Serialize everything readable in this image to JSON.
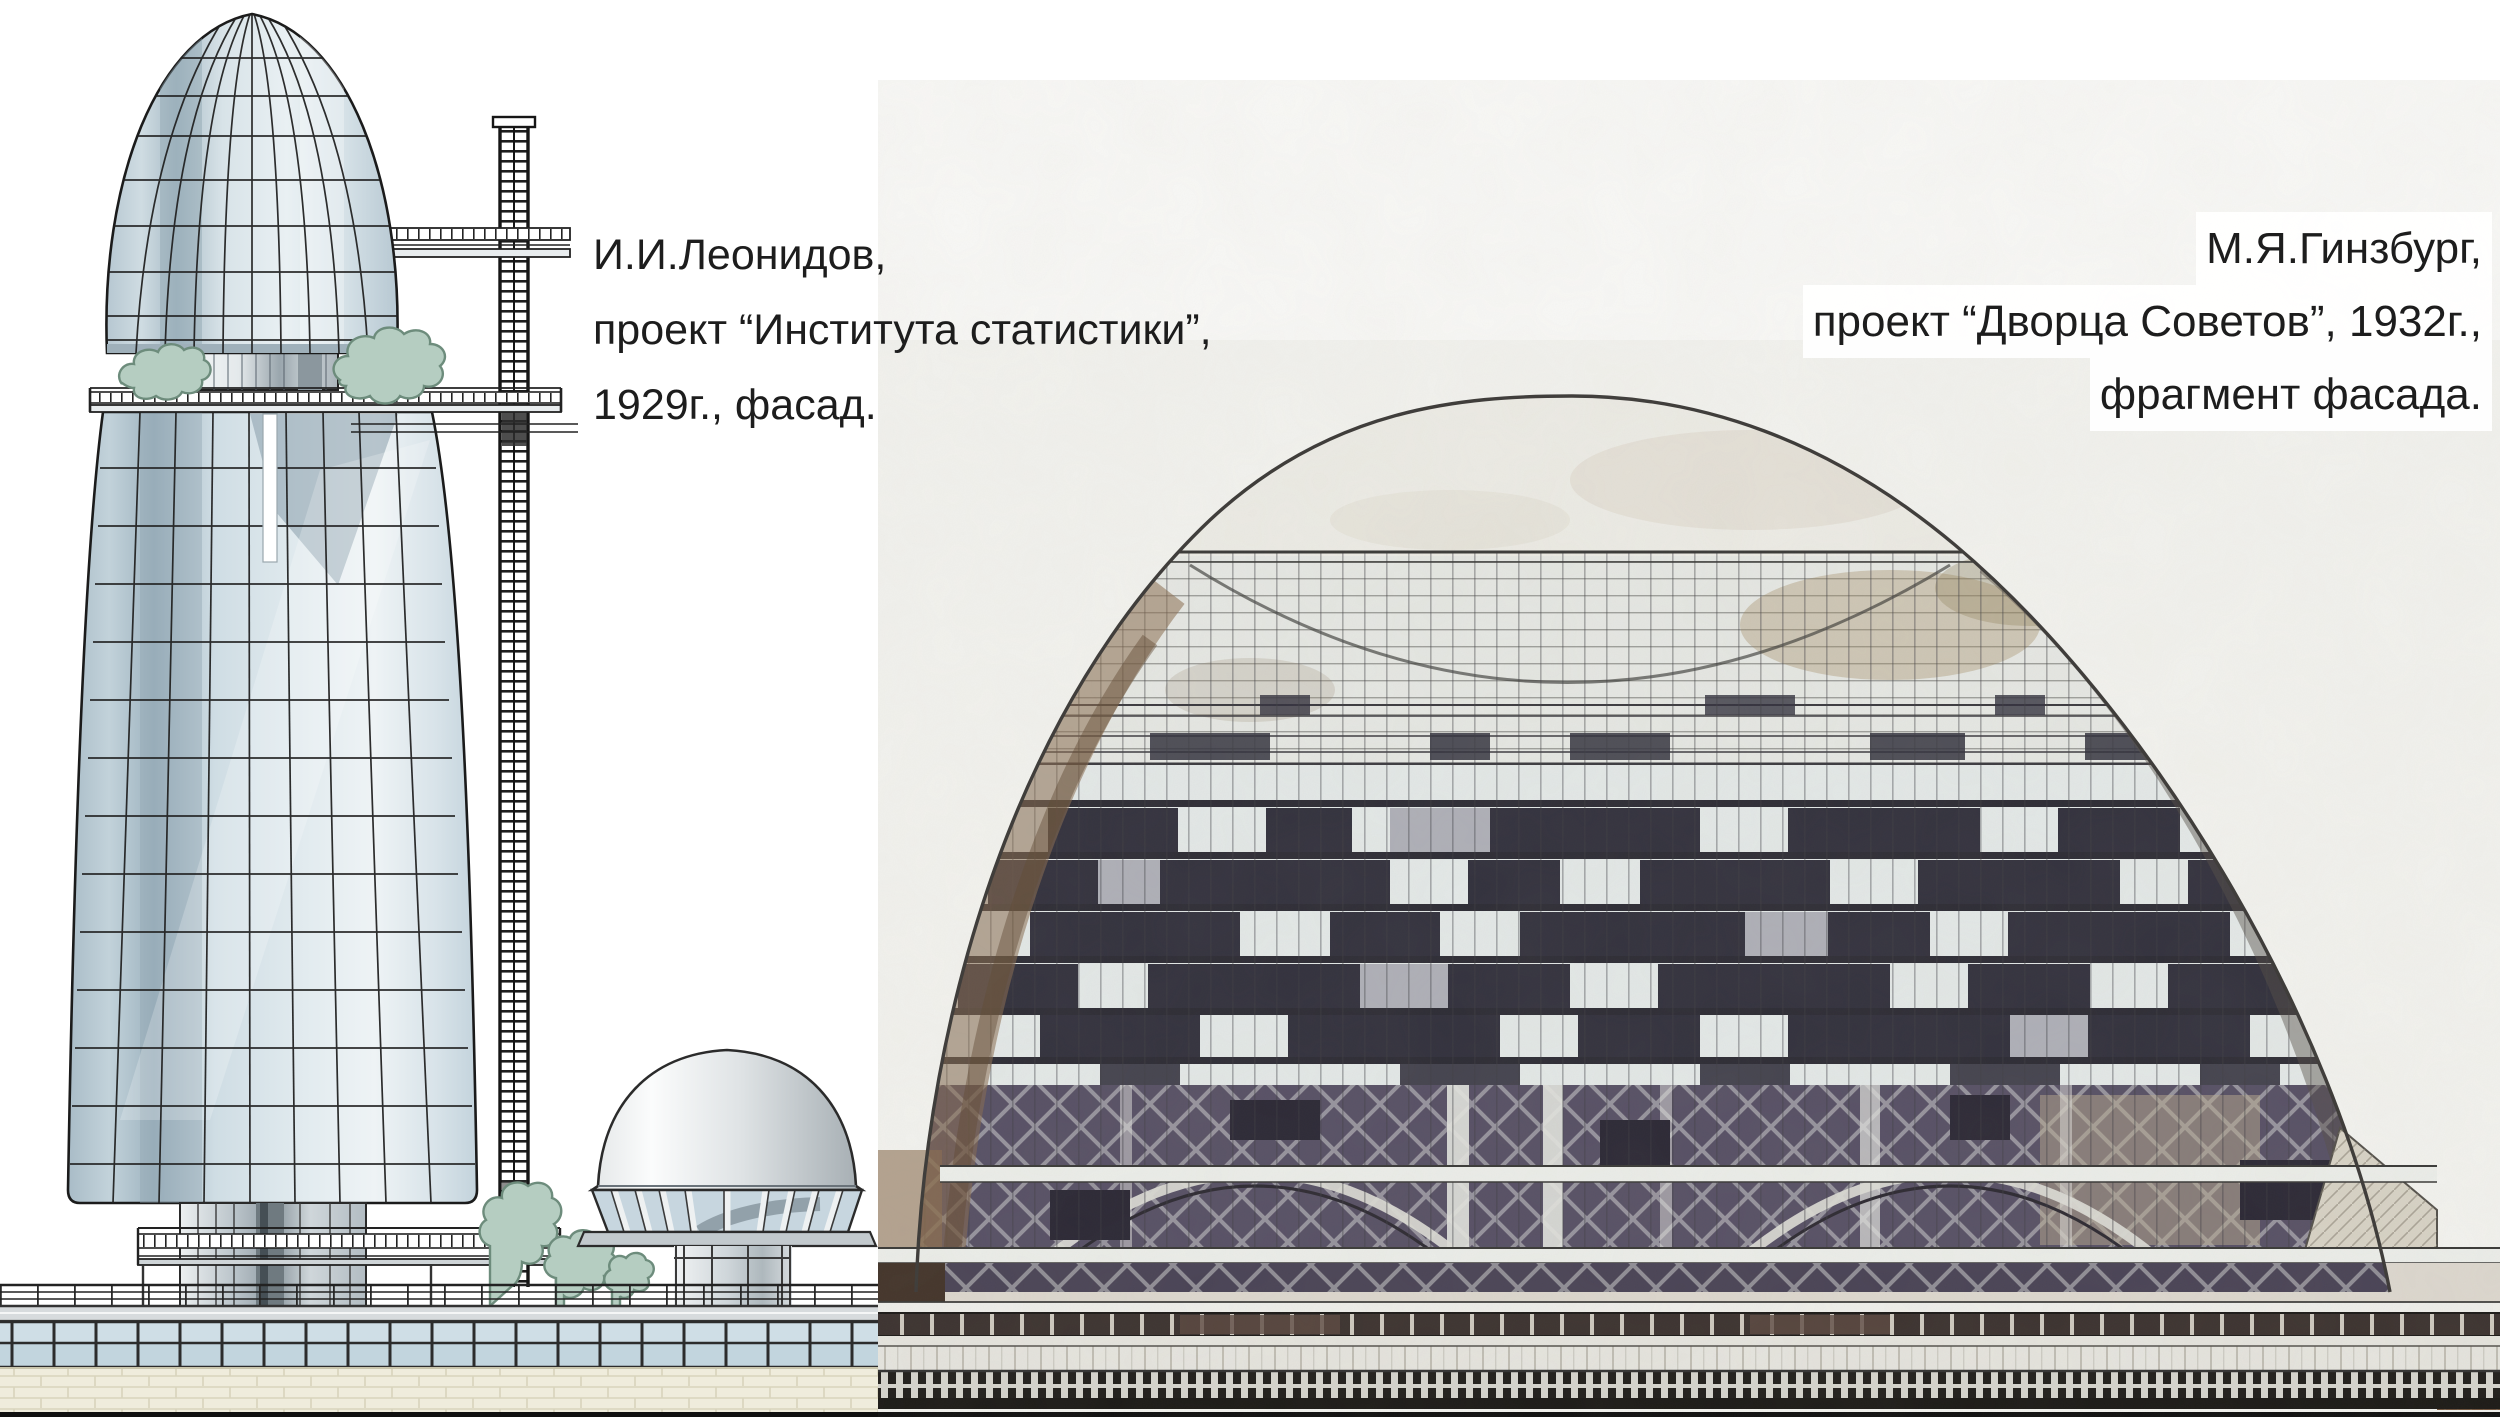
{
  "captions": {
    "left": {
      "lines": [
        "И.И.Леонидов,",
        "проект “Института статистики”,",
        "1929г., фасад."
      ]
    },
    "right": {
      "lines": [
        "М.Я.Гинзбург,",
        "проект “Дворца Советов”, 1932г.,",
        "фрагмент фасада."
      ]
    }
  },
  "palette": {
    "page_bg": "#ffffff",
    "photo_bg": "#f3f3ef",
    "tower_line": "#1c1c1c",
    "foliage": "#b5cdc1",
    "foliage_line": "#6d8c7c",
    "checker_dark": "#33323e",
    "truss_bg": "#585166",
    "podium_dark": "#43342a",
    "band_glass": "#c2d5de",
    "brick_bg": "#efecdc",
    "base_line": "#101010"
  }
}
